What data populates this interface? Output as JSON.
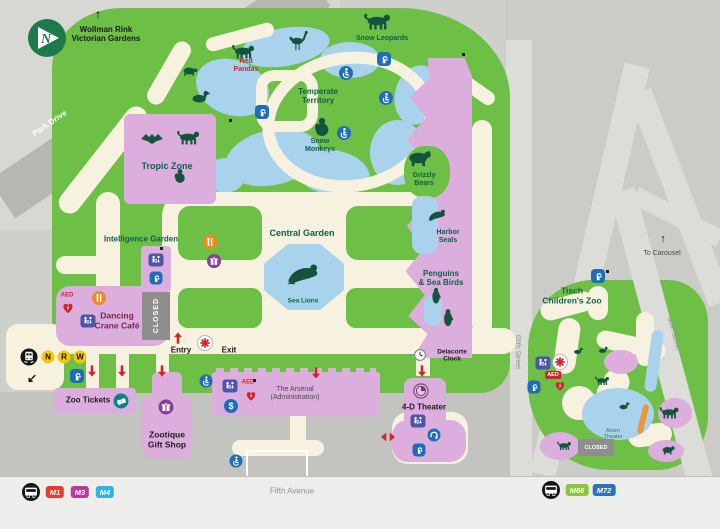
{
  "compass": {
    "label": "N"
  },
  "navigation": {
    "wollman": "Wollman Rink\nVictorian Gardens",
    "to_carousel": "To Carousel",
    "entry": "Entry",
    "exit": "Exit"
  },
  "streets": {
    "park_drive": "Park Drive",
    "fifth_avenue": "Fifth Avenue",
    "street_65": "65th Street",
    "street_66": "66th Street"
  },
  "zones": {
    "tropic_zone": "Tropic Zone",
    "temperate_territory": "Temperate\nTerritory",
    "intelligence_garden": "Intelligence Garden",
    "central_garden": "Central Garden",
    "sea_lions": "Sea Lions",
    "red_pandas": "Red\nPandas",
    "snow_leopards": "Snow Leopards",
    "snow_monkeys": "Snow\nMonkeys",
    "grizzly_bears": "Grizzly\nBears",
    "harbor_seals": "Harbor\nSeals",
    "penguins_sea_birds": "Penguins\n& Sea Birds",
    "tisch_childrens_zoo": "Tisch\nChildren's Zoo",
    "acorn_theater": "Acorn\nTheater"
  },
  "facilities": {
    "dancing_crane_cafe": "Dancing\nCrane Café",
    "zoo_tickets": "Zoo Tickets",
    "zootique_gift_shop": "Zootique\nGift Shop",
    "arsenal": "The Arsenal\n(Administration)",
    "theater_4d": "4-D Theater",
    "delacorte_clock": "Delacorte\nClock",
    "closed": "CLOSED",
    "aed": "AED"
  },
  "transit": {
    "subway_lines": [
      "N",
      "R",
      "W"
    ],
    "bus_routes_left": [
      "M1",
      "M3",
      "M4"
    ],
    "bus_routes_right": [
      "M66",
      "M72"
    ]
  },
  "palette": {
    "zoo_green": "#6dbf45",
    "path_cream": "#f7f2df",
    "water_blue": "#a9d3ec",
    "building_pink": "#dcaede",
    "road_gray": "#b7b7b4",
    "sidewalk_gray": "#c3c3c0",
    "label_green": "#0e5f46",
    "accent_red": "#d3232a",
    "icon_blue": "#1e6db6",
    "restroom_blue": "#4d55a8",
    "food_orange": "#ef8b20",
    "gift_purple": "#8a3f95",
    "ticket_teal": "#0d7f8d",
    "subway_yellow": "#f6c60d",
    "m1_red": "#e93a2a",
    "m3_magenta": "#bb3a92",
    "m4_cyan": "#2db3e8",
    "m66_green": "#8cc540",
    "m72_blue": "#2e73ba"
  }
}
